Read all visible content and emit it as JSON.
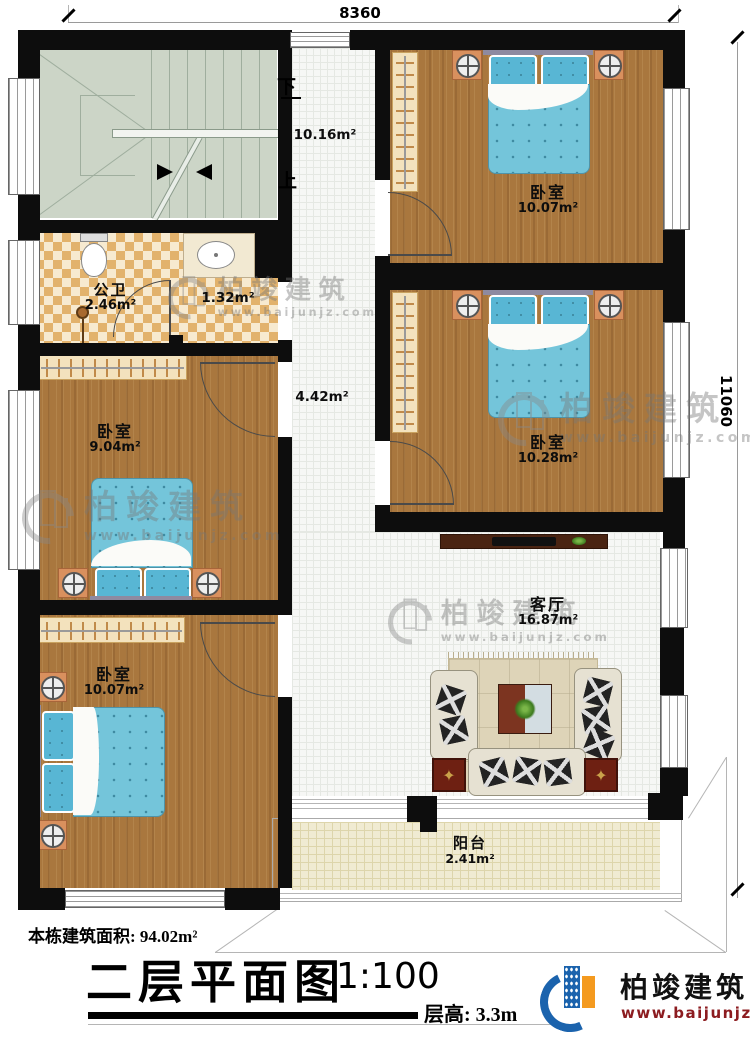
{
  "dimensions": {
    "width": "8360",
    "height": "11060"
  },
  "stairs": {
    "down": "下",
    "up": "上"
  },
  "rooms": [
    {
      "id": "bedroom-top-right",
      "name": "卧室",
      "area": "10.07m²"
    },
    {
      "id": "bedroom-mid-right",
      "name": "卧室",
      "area": "10.28m²"
    },
    {
      "id": "bathroom",
      "name": "公卫",
      "area": "2.46m²"
    },
    {
      "id": "bath-anteroom",
      "name": "",
      "area": "1.32m²"
    },
    {
      "id": "hallway",
      "name": "",
      "area": "4.42m²"
    },
    {
      "id": "stairwell",
      "name": "",
      "area": "10.16m²"
    },
    {
      "id": "bedroom-mid-left",
      "name": "卧室",
      "area": "9.04m²"
    },
    {
      "id": "bedroom-bottom-left",
      "name": "卧室",
      "area": "10.07m²"
    },
    {
      "id": "living-room",
      "name": "客厅",
      "area": "16.87m²"
    },
    {
      "id": "balcony",
      "name": "阳台",
      "area": "2.41m²"
    }
  ],
  "footer": {
    "building_area": "本栋建筑面积: 94.02m²",
    "title": "二层平面图",
    "scale": "1:100",
    "floor_height": "层高: 3.3m"
  },
  "brand": {
    "name": "柏竣建筑",
    "url": "www.baijunjz.com"
  },
  "watermark": {
    "name": "柏竣建筑",
    "url": "www.baijunjz.com"
  },
  "colors": {
    "wall": "#0d0d0d",
    "wood": "#a9773e",
    "bed": "#74c5da",
    "brand_blue": "#1b63ad",
    "brand_orange": "#f49a1f",
    "brand_red": "#8c1c20"
  }
}
